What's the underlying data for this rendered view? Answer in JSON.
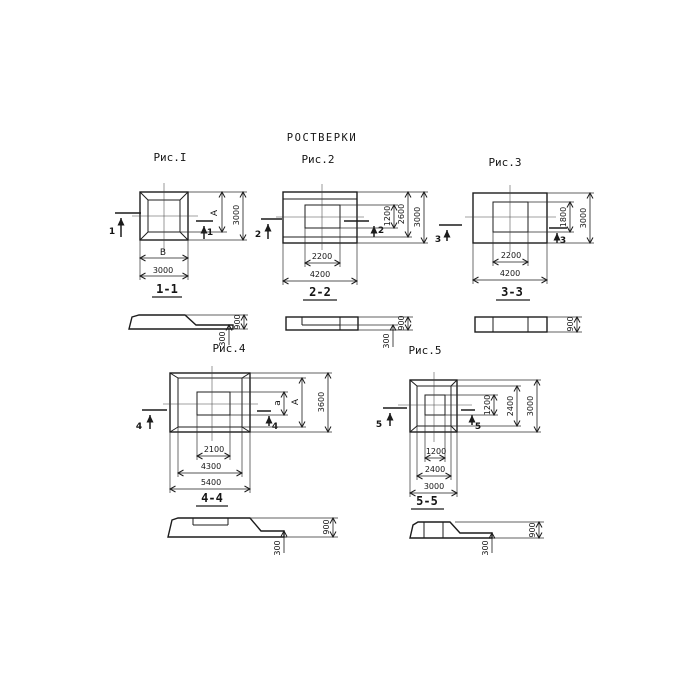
{
  "title": "РОСТВЕРКИ",
  "colors": {
    "ink": "#1c1c1c",
    "paper": "#ffffff"
  },
  "figures": [
    {
      "caption": "Рис.I",
      "cut_label": "1",
      "section_title": "1-1",
      "plan_dims": {
        "right_inner": "А",
        "right_outer": "3000",
        "bottom_inner": "В",
        "bottom_outer": "3000"
      },
      "section_dims": {
        "total_height": "900",
        "slab_height": "300"
      }
    },
    {
      "caption": "Рис.2",
      "cut_label": "2",
      "section_title": "2-2",
      "plan_dims": {
        "right_inner": "1200",
        "right_middle": "2600",
        "right_outer": "3000",
        "bottom_inner": "2200",
        "bottom_outer": "4200"
      },
      "section_dims": {
        "total_height": "900",
        "slab_height": "300"
      }
    },
    {
      "caption": "Рис.3",
      "cut_label": "3",
      "section_title": "3-3",
      "plan_dims": {
        "right_inner": "1800",
        "right_outer": "3000",
        "bottom_inner": "2200",
        "bottom_outer": "4200"
      },
      "section_dims": {
        "total_height": "900"
      }
    },
    {
      "caption": "Рис.4",
      "cut_label": "4",
      "section_title": "4-4",
      "plan_dims": {
        "right_inner": "а",
        "right_middle": "А",
        "right_outer": "3600",
        "bottom_inner": "2100",
        "bottom_middle": "4300",
        "bottom_outer": "5400"
      },
      "section_dims": {
        "total_height": "900",
        "slab_height": "300"
      }
    },
    {
      "caption": "Рис.5",
      "cut_label": "5",
      "section_title": "5-5",
      "plan_dims": {
        "right_inner": "1200",
        "right_middle": "2400",
        "right_outer": "3000",
        "bottom_inner": "1200",
        "bottom_middle": "2400",
        "bottom_outer": "3000"
      },
      "section_dims": {
        "total_height": "900",
        "slab_height": "300"
      }
    }
  ]
}
